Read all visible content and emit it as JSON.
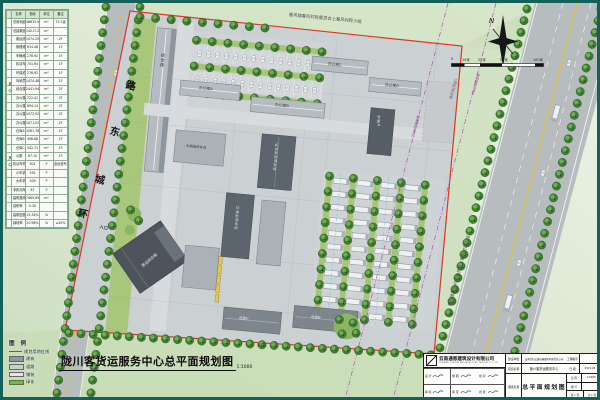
{
  "page": {
    "frame_color": "#156058"
  },
  "indicator_table": {
    "headers": [
      "名称",
      "指标",
      "单位",
      "备注"
    ],
    "among_label": "其 中",
    "rows": [
      {
        "name": "总用地面积",
        "value": "48813.95",
        "unit": "m²",
        "note": "73.2亩",
        "indent": false
      },
      {
        "name": "总建筑面积",
        "value": "14217.28",
        "unit": "m²",
        "note": "",
        "indent": false
      },
      {
        "name": "客运综合楼",
        "value": "1074.25",
        "unit": "m²",
        "note": "2F",
        "indent": true
      },
      {
        "name": "管理维修用房",
        "value": "634.48",
        "unit": "m²",
        "note": "1F",
        "indent": true
      },
      {
        "name": "车辆维修车间",
        "value": "276.92",
        "unit": "m²",
        "note": "1F",
        "indent": true
      },
      {
        "name": "机动车检测车间",
        "value": "701.94",
        "unit": "m²",
        "note": "1F",
        "indent": true
      },
      {
        "name": "环保检测车间",
        "value": "276.92",
        "unit": "m²",
        "note": "1F",
        "indent": true
      },
      {
        "name": "驾驶员休息室",
        "value": "1474.48",
        "unit": "m²",
        "note": "1F",
        "indent": true
      },
      {
        "name": "综合楼",
        "value": "2441.94",
        "unit": "m²",
        "note": "2F",
        "indent": true
      },
      {
        "name": "办公楼A",
        "value": "722.41",
        "unit": "m²",
        "note": "2F",
        "indent": true
      },
      {
        "name": "办公楼B",
        "value": "694.14",
        "unit": "m²",
        "note": "2F",
        "indent": true
      },
      {
        "name": "办公楼C",
        "value": "1072.02",
        "unit": "m²",
        "note": "2F",
        "indent": true
      },
      {
        "name": "办公楼D",
        "value": "1071.02",
        "unit": "m²",
        "note": "2F",
        "indent": true
      },
      {
        "name": "仓库A",
        "value": "1061.78",
        "unit": "m²",
        "note": "1F",
        "indent": true
      },
      {
        "name": "仓库B",
        "value": "498.88",
        "unit": "m²",
        "note": "1F",
        "indent": true
      },
      {
        "name": "仓库C",
        "value": "442.71",
        "unit": "m²",
        "note": "1F",
        "indent": true
      },
      {
        "name": "公厕",
        "value": "67.10",
        "unit": "m²",
        "note": "1F",
        "indent": true
      },
      {
        "name": "机动车停车位总数",
        "value": "301",
        "unit": "个",
        "note": "含运营车位",
        "indent": false
      },
      {
        "name": "小车机动车停车位",
        "value": "192",
        "unit": "个",
        "note": "",
        "indent": true
      },
      {
        "name": "大车机动车停车位",
        "value": "109",
        "unit": "个",
        "note": "",
        "indent": true
      },
      {
        "name": "非机动车停车位",
        "value": "87",
        "unit": "个",
        "note": "",
        "indent": false
      },
      {
        "name": "建筑基底面积",
        "value": "7465.69",
        "unit": "m²",
        "note": "",
        "indent": false
      },
      {
        "name": "容积率",
        "value": "0.30",
        "unit": "",
        "note": "",
        "indent": false
      },
      {
        "name": "建筑密度",
        "value": "15.34%",
        "unit": "%",
        "note": "",
        "indent": false
      },
      {
        "name": "绿地率",
        "value": "20.96%",
        "unit": "%",
        "note": "≥20%",
        "indent": false
      }
    ]
  },
  "legend": {
    "title": "图 例",
    "items": [
      {
        "label": "规划用地红线",
        "swatch": "redline"
      },
      {
        "label": "建筑",
        "swatch": "building"
      },
      {
        "label": "道路",
        "swatch": "road"
      },
      {
        "label": "铺装",
        "swatch": "paving"
      },
      {
        "label": "绿化",
        "swatch": "green"
      }
    ]
  },
  "main_title": {
    "text": "陇川客货运服务中心总平面规划图",
    "scale": "1:1000"
  },
  "compass": {
    "north_label": "N"
  },
  "scale_bar": {
    "labels": [
      "0",
      "10米",
      "25米",
      "50米",
      "100米"
    ]
  },
  "plan": {
    "village_note": "春风镇春风村民委员会上春风村民小组",
    "road_name_chars": [
      "环",
      "城",
      "东",
      "路"
    ],
    "labels": {
      "zonghelou": "综合楼",
      "bangonglou_a": "办公楼A",
      "bangonglou_b": "办公楼B",
      "bangonglou_c": "办公楼C",
      "bangonglou_d": "办公楼D",
      "jiance": "机动车检测车间",
      "huanbao": "环保检测车间",
      "weixiu": "车辆维修车间",
      "keyun": "客运综合楼",
      "cangku_a": "仓库A",
      "cangku_b": "仓库B",
      "cangku_c": "仓库C",
      "duiliao": "堆料场(预留)",
      "kv35": "35KV线路走廊",
      "entrance": "入口"
    }
  },
  "title_block": {
    "company": "云南通恩建筑设计有限公司",
    "company_en": "YUNNAN TONGEN ARCHITECTURE DESIGN CO.,LTD.",
    "sign_cells": [
      {
        "label": "设 计"
      },
      {
        "label": "制 图"
      },
      {
        "label": "校 对"
      },
      {
        "label": "审 核"
      },
      {
        "label": "审 定"
      },
      {
        "label": "批 准"
      }
    ],
    "fields": {
      "owner_label": "建设单位",
      "owner": "云南世纪交通运输集团有限责任公司",
      "no_label": "工程编号",
      "no": "",
      "project_label": "项目名称",
      "project": "陇川客货运服务中心",
      "date_label": "日 期",
      "date": "2021.04",
      "drawing_label": "图纸名称",
      "drawing": "总平面规划图",
      "scale_label": "比 例",
      "scale": "1:1000",
      "fig_label": "图 号",
      "fig": "",
      "sheet": "第 1 张",
      "sheets": "共 1 张"
    }
  }
}
